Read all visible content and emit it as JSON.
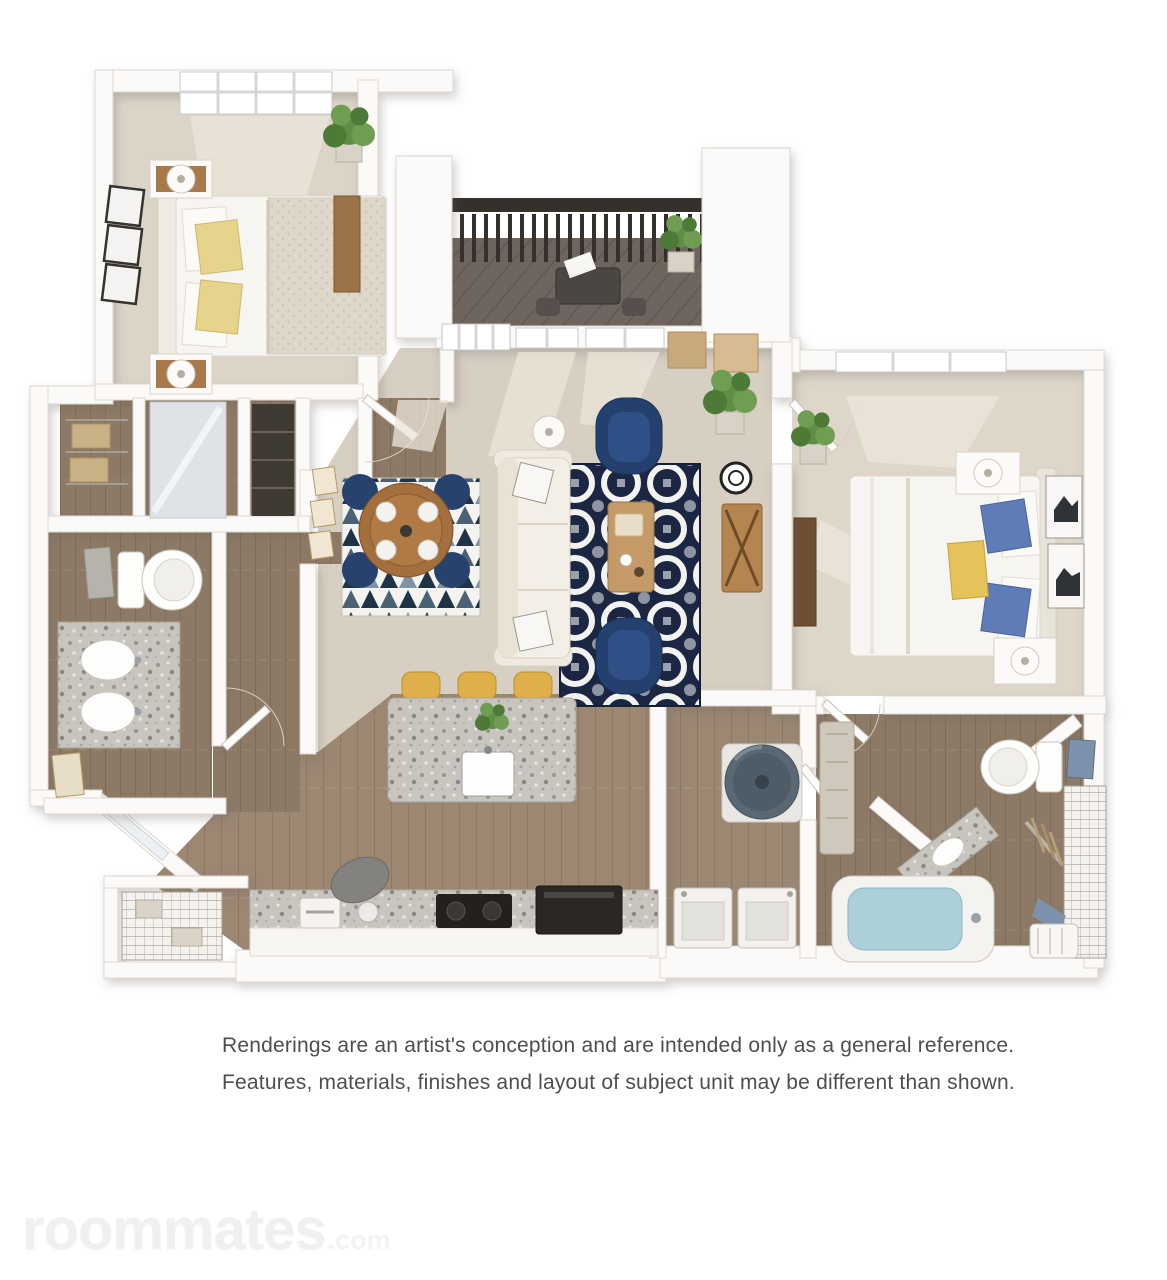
{
  "image": {
    "kind": "3d-floor-plan-rendering",
    "description": "Top-down 3D rendering of a two-bedroom, two-bathroom apartment with balcony, open living/dining, kitchen island, laundry room and walk-in closets"
  },
  "disclaimer": {
    "line1": "Renderings are an artist's conception and are intended only as a general reference.",
    "line2": "Features, materials, finishes and layout of subject unit may be different than shown."
  },
  "watermark": {
    "brand": "roommates",
    "tld": ".com"
  },
  "palette": {
    "background": "#ffffff",
    "wall": "#fbfaf8",
    "wall_edge": "#dcd7cf",
    "carpet": "#d7d0c3",
    "carpet_sun": "#ece6d9",
    "wood_kitchen": "#9b8772",
    "wood_bath": "#8d7a66",
    "deck": "#6e655e",
    "rug_navy": "#1b2742",
    "rug_triangle_steel": "#4a6174",
    "rug_triangle_navy": "#1f3346",
    "armchair_navy": "#24406f",
    "pillow_blue": "#5e7cb8",
    "accent_yellow": "#dfb049",
    "pillow_yellow": "#e6d38c",
    "table_wood": "#a26f3d",
    "granite": "#c8c5bf",
    "tub_water": "#abd0da",
    "plant_green": "#5f8f46",
    "railing_dark": "#34312d",
    "text_gray": "#4e4e4e",
    "watermark_gray": "#f0f0f0"
  },
  "floor_plan": {
    "rooms": [
      {
        "name": "bedroom-1",
        "furniture": [
          "bed",
          "nightstands",
          "lamps",
          "leaning-frames",
          "dresser",
          "plant",
          "window"
        ]
      },
      {
        "name": "balcony",
        "furniture": [
          "railing",
          "deck",
          "bistro-table",
          "potted-plant"
        ]
      },
      {
        "name": "living-room",
        "furniture": [
          "sofa",
          "navy-armchairs",
          "coffee-table",
          "navy-pattern-rug",
          "floor-lamp",
          "side-table",
          "media-console",
          "wall-art",
          "plant"
        ]
      },
      {
        "name": "dining-area",
        "furniture": [
          "round-table",
          "navy-chairs",
          "triangle-rug",
          "place-settings"
        ]
      },
      {
        "name": "kitchen",
        "furniture": [
          "granite-island",
          "sink",
          "bar-stools",
          "counter",
          "cooktop",
          "range",
          "toaster",
          "desk-chair",
          "pantry"
        ]
      },
      {
        "name": "bedroom-2",
        "furniture": [
          "bed",
          "nightstands",
          "lamps",
          "wall-art",
          "dresser",
          "plant",
          "window"
        ]
      },
      {
        "name": "bathroom-1",
        "furniture": [
          "toilet",
          "double-vanity",
          "mirror"
        ]
      },
      {
        "name": "bathroom-2",
        "furniture": [
          "bathtub",
          "toilet",
          "vanity"
        ]
      },
      {
        "name": "laundry-room",
        "furniture": [
          "water-heater",
          "washer",
          "dryer"
        ]
      },
      {
        "name": "walk-in-closets",
        "furniture": [
          "wire-shelving",
          "storage-boxes",
          "hanging-rod",
          "laundry-basket"
        ]
      }
    ]
  }
}
